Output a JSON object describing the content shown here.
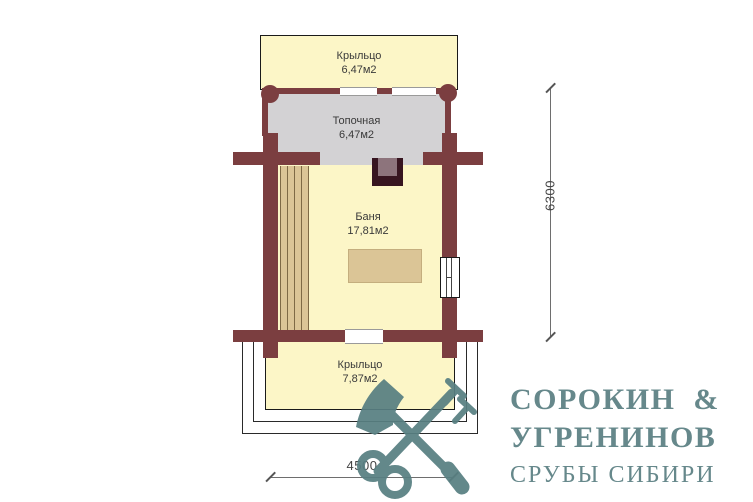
{
  "plan": {
    "rooms": [
      {
        "id": "porch-top",
        "name": "Крыльцо",
        "area": "6,47м2"
      },
      {
        "id": "boiler-room",
        "name": "Топочная",
        "area": "6,47м2"
      },
      {
        "id": "bath-room",
        "name": "Баня",
        "area": "17,81м2"
      },
      {
        "id": "porch-bottom",
        "name": "Крыльцо",
        "area": "7,87м2"
      }
    ],
    "dimensions": {
      "vertical": "6300",
      "horizontal": "4500"
    },
    "features": [
      "stove",
      "bench-planks",
      "table",
      "window",
      "door-openings",
      "porch-steps",
      "log-end-posts"
    ]
  },
  "logo": {
    "line1": "СОРОКИН  &",
    "line2": "УГРЕНИНОВ",
    "line3": "СРУБЫ СИБИРИ",
    "icon": "axe-and-key-icon"
  },
  "colors": {
    "wall": "#7b3e40",
    "floor": "#fcf6c7",
    "boiler_floor": "#d3d2d4",
    "wood": "#dbc596",
    "stove_outer": "#371520",
    "stove_inner": "#8d747c",
    "logo": "#66888b",
    "logo_icon": "#587f82"
  }
}
